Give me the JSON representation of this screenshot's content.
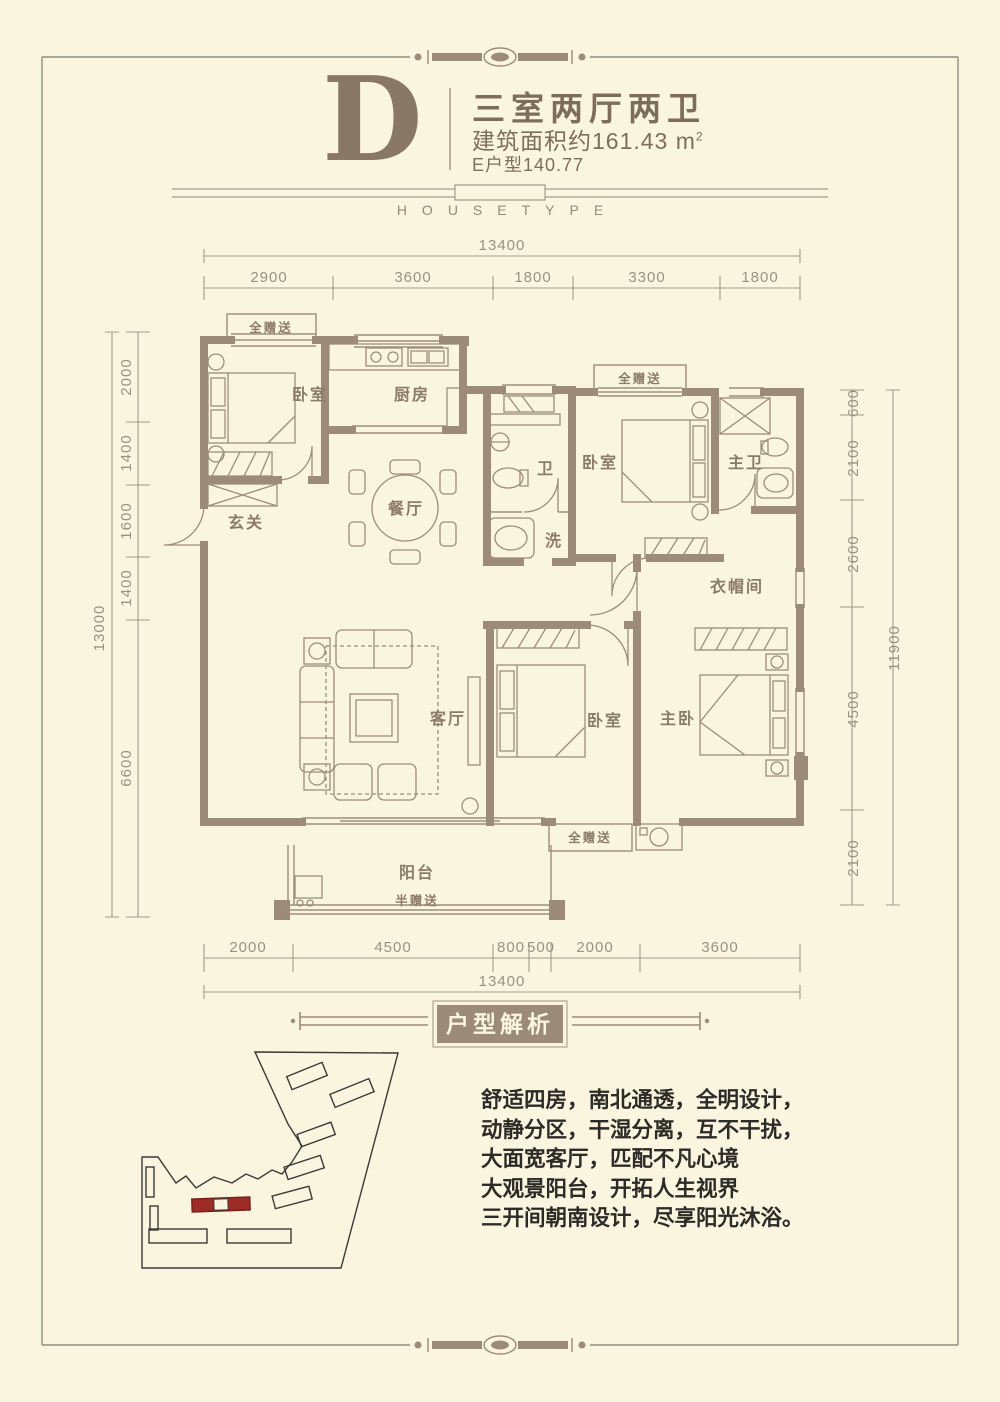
{
  "header": {
    "letter": "D",
    "title": "三室两厅两卫",
    "area_text": "建筑面积约161.43 m",
    "area_sup": "2",
    "subtitle": "E户型140.77",
    "housetype": "HOUSETYPE"
  },
  "plan": {
    "rooms": {
      "bedroom_nw": "卧室",
      "kitchen": "厨房",
      "dining": "餐厅",
      "foyer": "玄关",
      "bath": "卫",
      "wash": "洗",
      "bedroom_n": "卧室",
      "master_bath": "主卫",
      "cloakroom": "衣帽间",
      "living": "客厅",
      "bedroom_s": "卧室",
      "master_bedroom": "主卧",
      "balcony": "阳台"
    },
    "gifts": {
      "full": "全赠送",
      "half": "半赠送"
    },
    "dims": {
      "top": {
        "total": "13400",
        "segments": [
          "2900",
          "3600",
          "1800",
          "3300",
          "1800"
        ]
      },
      "bottom": {
        "total": "13400",
        "segments": [
          "2000",
          "4500",
          "800",
          "500",
          "2000",
          "3600"
        ]
      },
      "left": {
        "total": "13000",
        "segments": [
          "2000",
          "1400",
          "1600",
          "1400",
          "6600"
        ]
      },
      "right": {
        "total": "11900",
        "segments": [
          "600",
          "2100",
          "2600",
          "4500",
          "2100"
        ]
      }
    }
  },
  "analysis": {
    "badge": "户型解析",
    "lines": [
      "舒适四房，南北通透，全明设计，",
      "动静分区，干湿分离，互不干扰，",
      "大面宽客厅，匹配不凡心境",
      "大观景阳台，开拓人生视界",
      "三开间朝南设计，尽享阳光沐浴。"
    ]
  },
  "colors": {
    "background": "#FAF5DE",
    "wall": "#9C8B78",
    "thin_line": "#9C8D7A",
    "dim": "#9B9183",
    "room_text": "#8B7C6A",
    "header_text": "#7D6E5C",
    "badge_bg": "#9C8B78",
    "description_text": "#2D2B27",
    "site_outline": "#3A3A38",
    "highlight_red": "#9E2B25"
  }
}
